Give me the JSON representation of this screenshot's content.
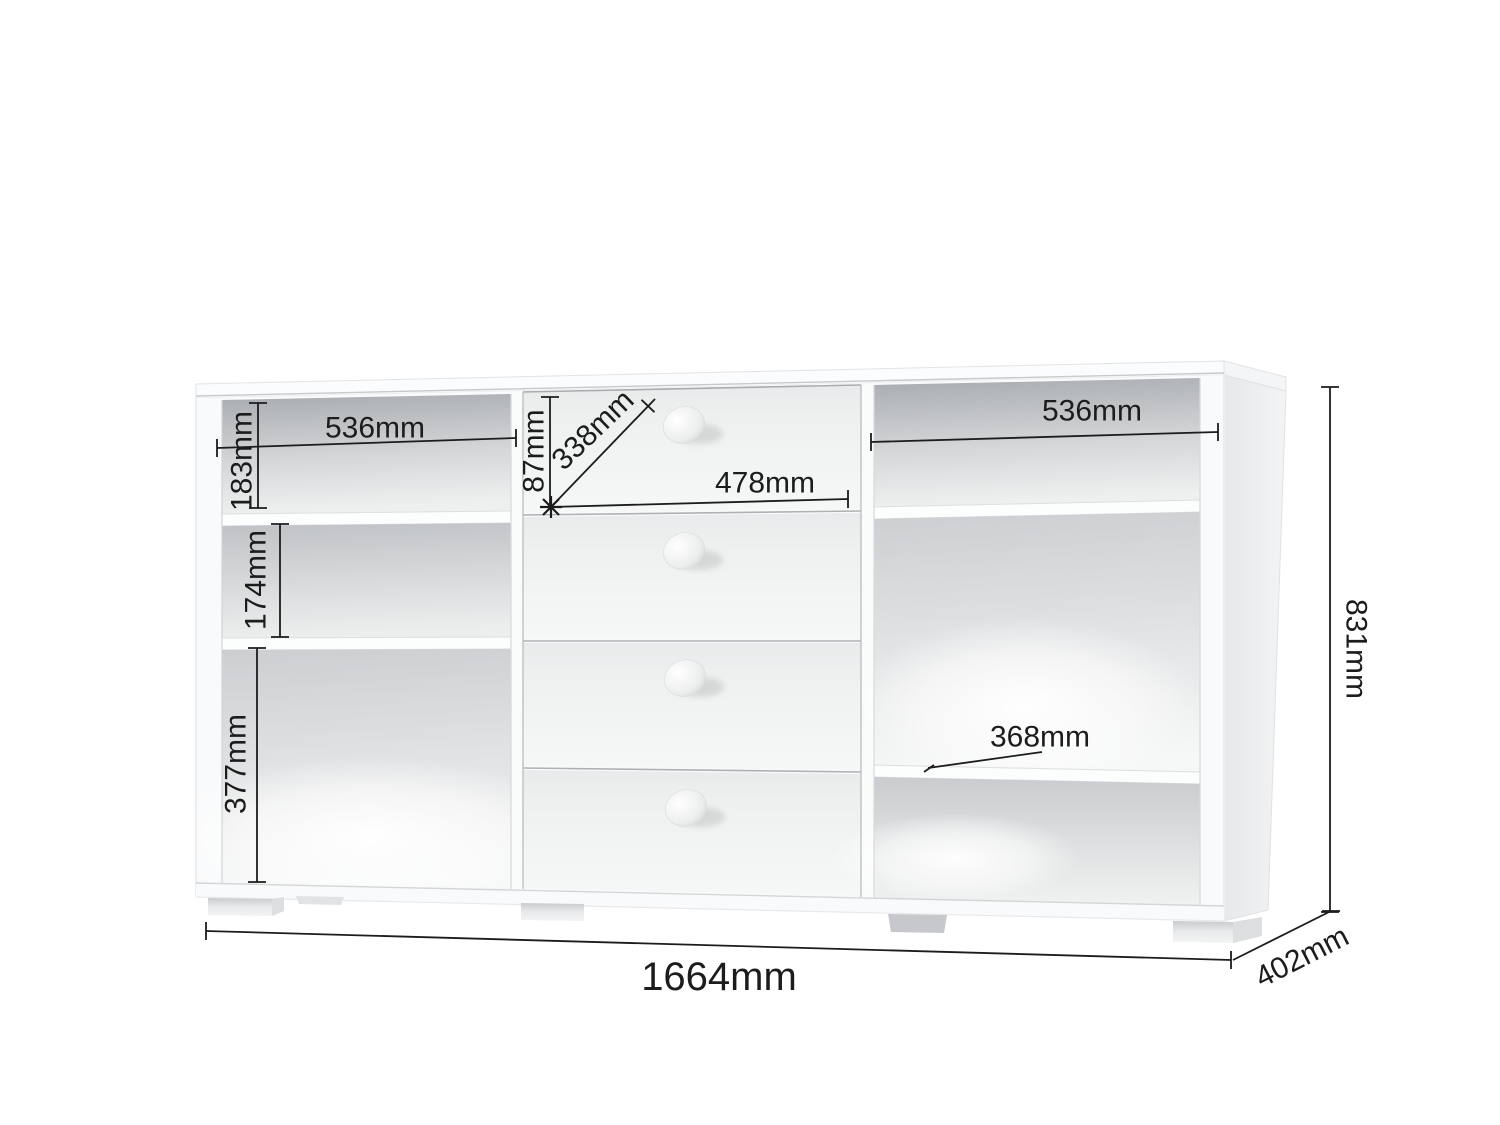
{
  "colors": {
    "dimension_line": "#1c1c1c",
    "label_text": "#1c1c1c",
    "background": "#ffffff",
    "cabinet_white": "#fbfcfd",
    "interior_shadow": "#a7abaf"
  },
  "dimensions": {
    "left_shelf_width": "536mm",
    "left_top_compartment_height": "183mm",
    "left_middle_compartment_height": "174mm",
    "left_bottom_compartment_height": "377mm",
    "top_drawer_height": "87mm",
    "drawer_diagonal": "338mm",
    "drawer_width": "478mm",
    "right_shelf_width": "536mm",
    "right_shelf_depth": "368mm",
    "overall_height": "831mm",
    "overall_width": "1664mm",
    "overall_depth": "402mm"
  }
}
